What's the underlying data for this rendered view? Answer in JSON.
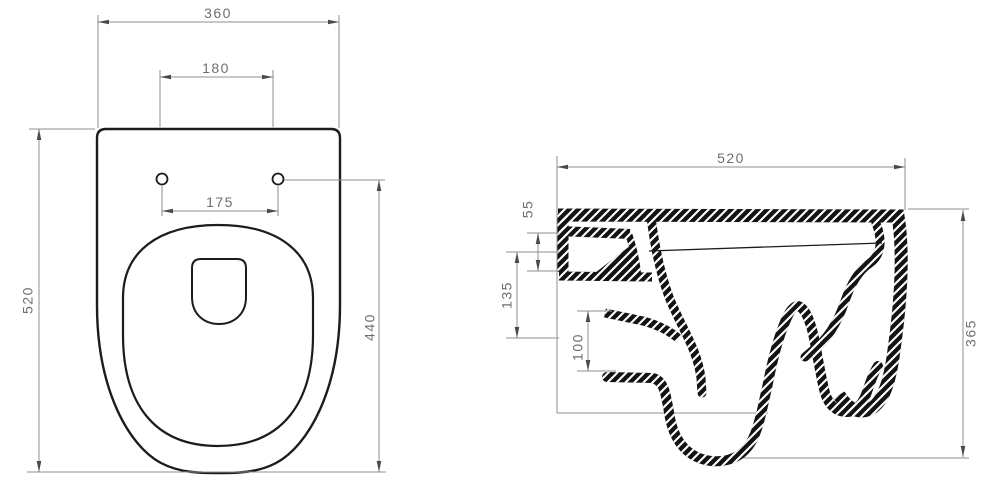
{
  "drawing_title": "wall-hung-toilet-dimension-drawing",
  "colors": {
    "background": "#ffffff",
    "ink": "#1c1c1c",
    "dim_line": "#8f8f8f",
    "dim_text": "#6e6e6e"
  },
  "top_view": {
    "dim_overall_width": "360",
    "dim_inner_width": "180",
    "dim_hole_spacing": "175",
    "dim_overall_depth": "520",
    "dim_holes_to_front": "440"
  },
  "section_view": {
    "dim_overall_depth": "520",
    "dim_rim_to_inlet": "55",
    "dim_inlet_to_outlet": "135",
    "dim_outlet_height": "100",
    "dim_overall_height": "365"
  }
}
